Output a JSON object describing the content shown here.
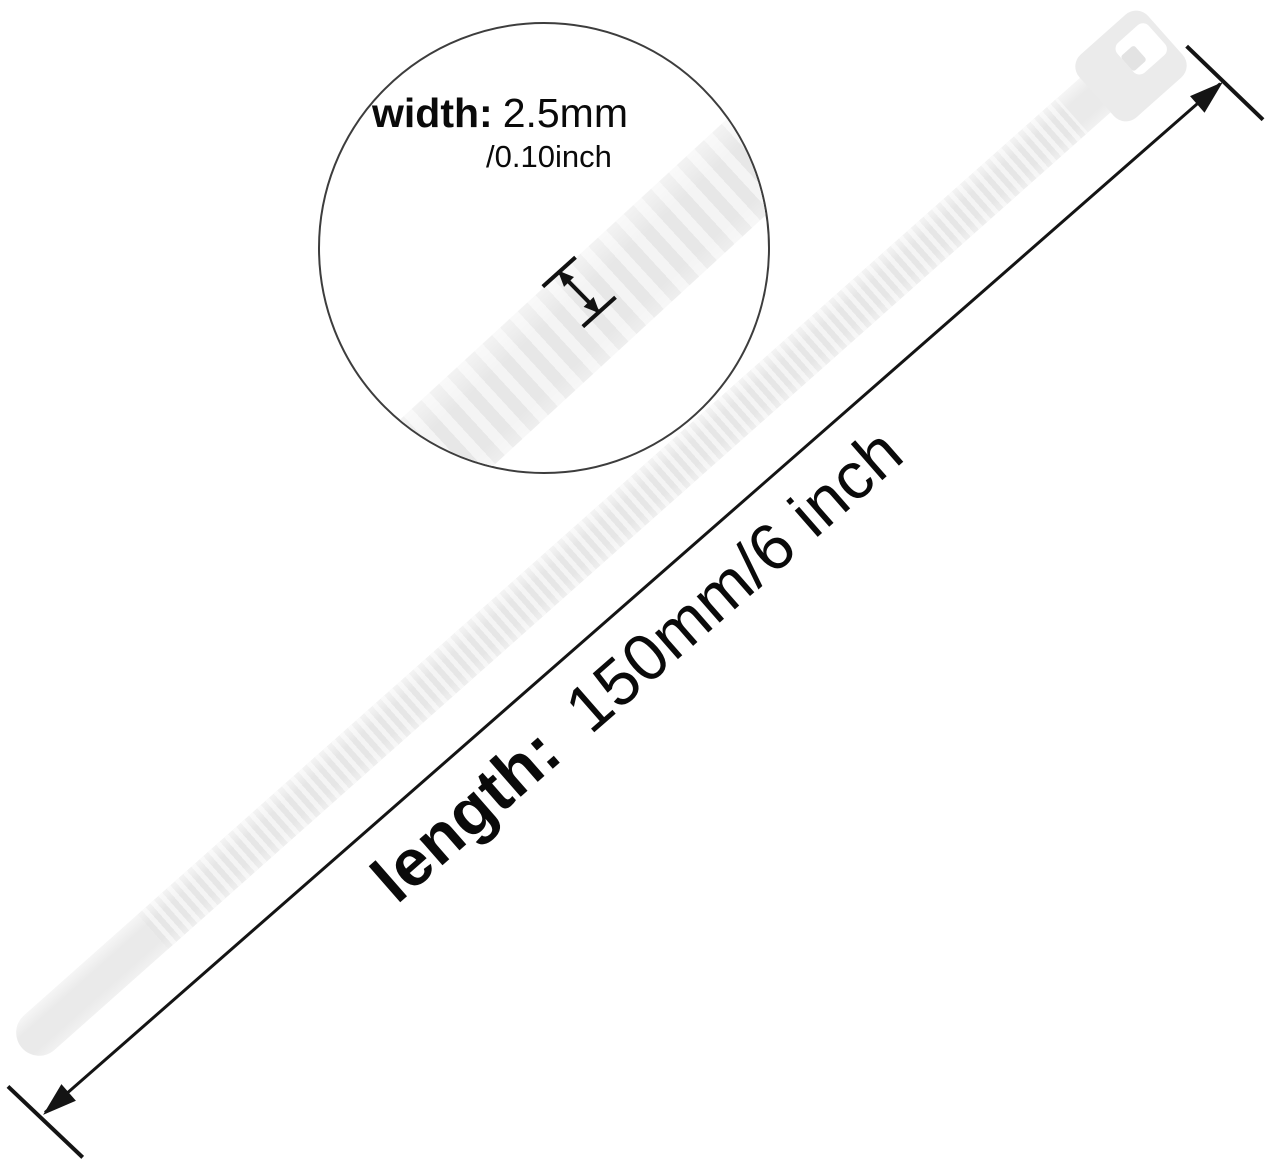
{
  "magnifier": {
    "width_label": "width:",
    "width_value_mm": "2.5mm",
    "width_value_inch": "/0.10inch"
  },
  "length_dimension": {
    "label": "length:",
    "value": "150mm/6 inch"
  },
  "colors": {
    "background": "#ffffff",
    "tie_body": "#eaeaea",
    "tie_rib_highlight": "#f4f4f4",
    "annotation_line": "#141414",
    "text": "#0a0a0a",
    "magnifier_border": "#3d3d3d"
  }
}
